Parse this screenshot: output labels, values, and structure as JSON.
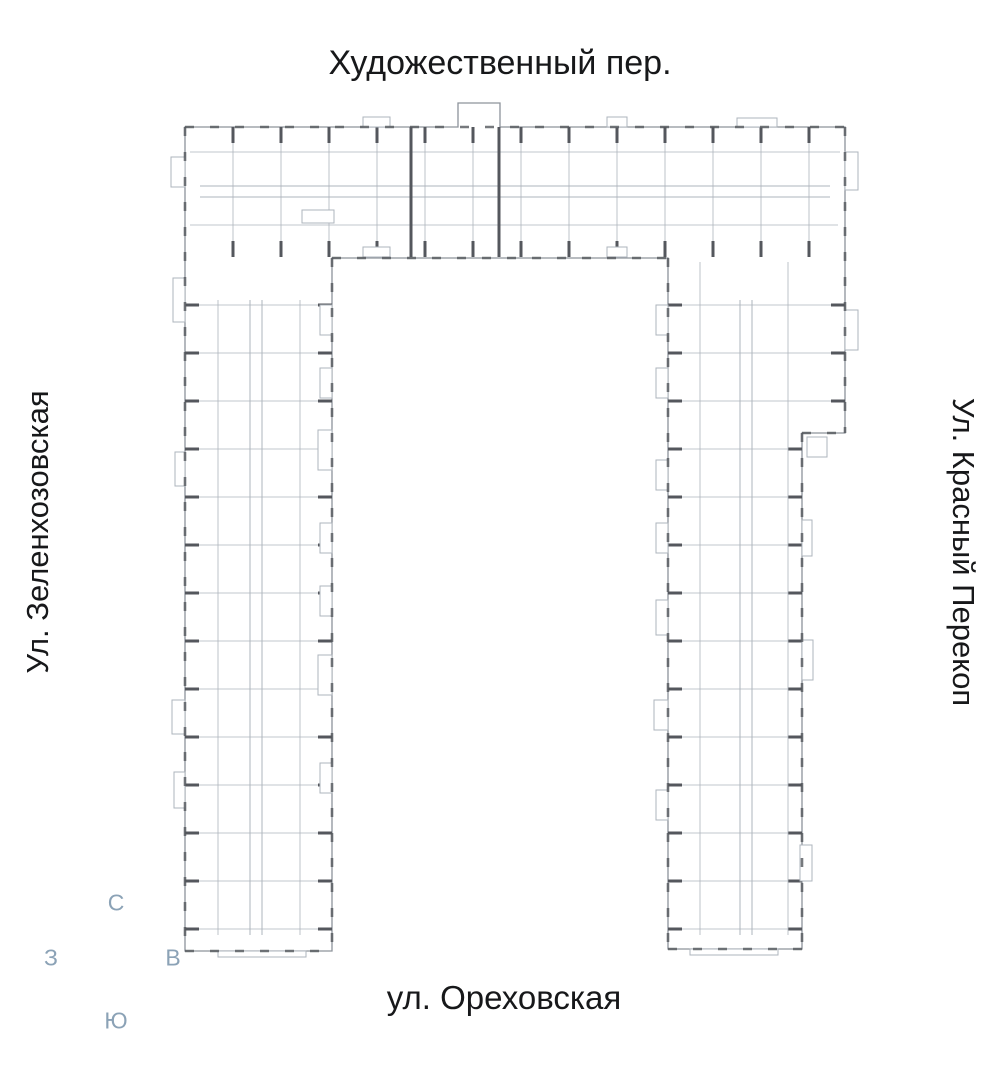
{
  "streets": {
    "top": "Художественный пер.",
    "left": "Ул. Зеленхозовская",
    "right": "Ул. Красный Перекоп",
    "bottom": "ул. Ореховская"
  },
  "compass": {
    "north": "С",
    "east": "В",
    "south": "Ю",
    "west": "З",
    "color": "#8ba2b6"
  },
  "floorplan": {
    "selected_unit": {
      "fill": "#7ccbd6",
      "stroke": "#3d9fae"
    },
    "elevator_color": "#2b4ea6",
    "wall_color": "#54575d",
    "line_color": "#aeb4bc",
    "hatch_color": "#c6cbd2",
    "outline_color": "#8d939b"
  }
}
